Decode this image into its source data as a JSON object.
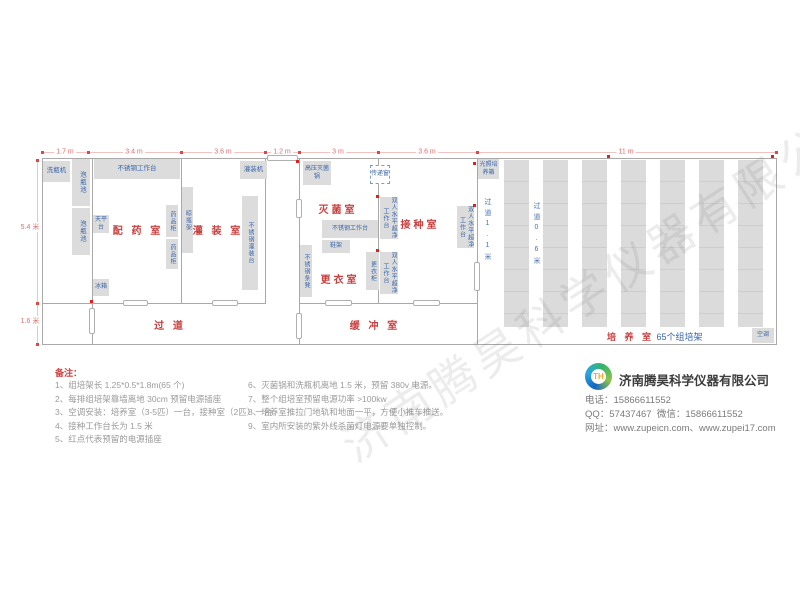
{
  "plan": {
    "dims_top": [
      "1.7 m",
      "3.4 m",
      "3.6 m",
      "1.2 m",
      "3 m",
      "3.6 m",
      "11 m"
    ],
    "dims_left": [
      "5.4 米",
      "1.6 米"
    ],
    "aisle1": "过道1.1米",
    "aisle2": "过道0.6米",
    "rooms": {
      "peiyao": "配 药 室",
      "guanzhuang": "灌 装 室",
      "miejun": "灭菌室",
      "gengyi": "更衣室",
      "jiezhong": "接种室",
      "guodao": "过  道",
      "huanchong": "缓 冲 室",
      "peiyang": "培 养 室",
      "peiyang_count": "65个组培架"
    },
    "equipment": {
      "washer": "洗瓶机",
      "soak": "泡瓶池",
      "bench": "不锈钢工作台",
      "balance": "天平台",
      "med_cabinet": "药品柜",
      "bottle_rack": "晾瓶架",
      "fridge": "冰箱",
      "filler": "灌装机",
      "fill_bench": "不锈钢灌装台",
      "autoclave": "高压灭菌锅",
      "pass_box": "传递窗",
      "shoe_rack": "鞋架",
      "locker": "更衣柜",
      "steel_bench": "不锈钢条凳",
      "clean_bench": "双人水平超净工作台",
      "light_incubator": "光照培养箱",
      "ac": "空调"
    }
  },
  "notes": {
    "title": "备注：",
    "col1": [
      "1、组培架长 1.25*0.5*1.8m(65 个)",
      "2、每排组培架靠墙离地 30cm 预留电源插座",
      "3、空调安装：培养室（3-5匹）一台，接种室（2匹）一台。",
      "4、接种工作台长为 1.5 米",
      "5、红点代表预留的电源插座"
    ],
    "col2": [
      "6、灭菌锅和洗瓶机离地 1.5 米，预留 380v 电源。",
      "7、整个组培室预留电源功率 >100kw",
      "8、培养室推拉门地轨和地面一平，方便小推车推送。",
      "9、室内所安装的紫外线杀菌灯电源要单独控制。"
    ]
  },
  "company": {
    "name": "济南腾昊科学仪器有限公司",
    "logo_initials": "TH",
    "phone_label": "电话：",
    "phone": "15866611552",
    "qq_label": "QQ：",
    "qq": "57437467",
    "wechat_label": "微信：",
    "wechat": "15866611552",
    "web_label": "网址：",
    "web": "www.zupeicn.com、www.zupei17.com"
  },
  "watermark": "济南腾昊科学仪器有限公司"
}
